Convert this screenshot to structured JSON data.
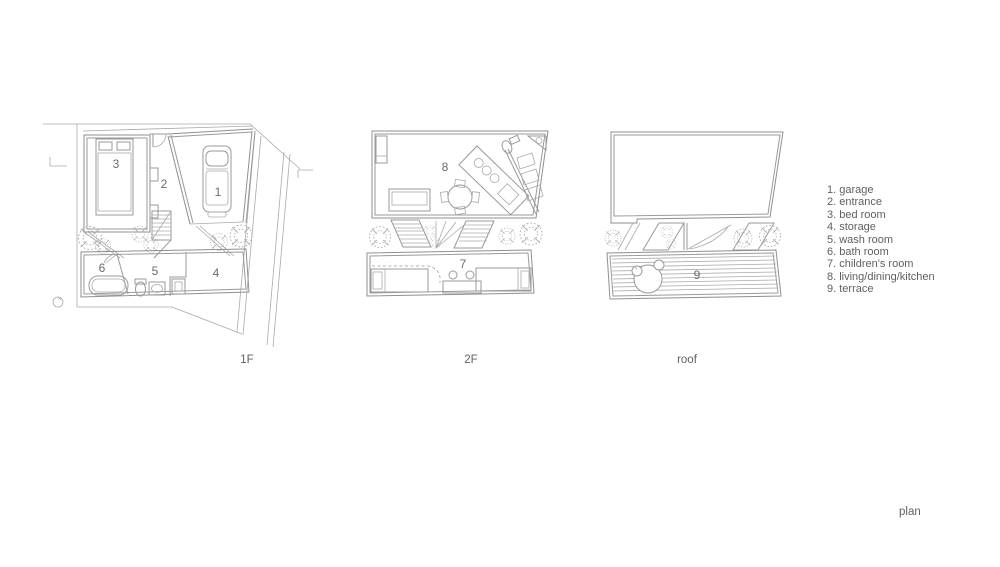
{
  "title": "plan",
  "floors": {
    "f1": "1F",
    "f2": "2F",
    "roof": "roof"
  },
  "rooms": {
    "garage": "1",
    "entrance": "2",
    "bed": "3",
    "storage": "4",
    "wash": "5",
    "bath": "6",
    "children": "7",
    "ldk": "8",
    "terrace": "9"
  },
  "legend": {
    "items": [
      "1. garage",
      "2. entrance",
      "3. bed room",
      "4. storage",
      "5. wash room",
      "6. bath room",
      "7. children's room",
      "8. living/dining/kitchen",
      "9. terrace"
    ]
  },
  "colors": {
    "line": "#9a9a9a",
    "text": "#5f5f5f",
    "background": "#ffffff"
  }
}
